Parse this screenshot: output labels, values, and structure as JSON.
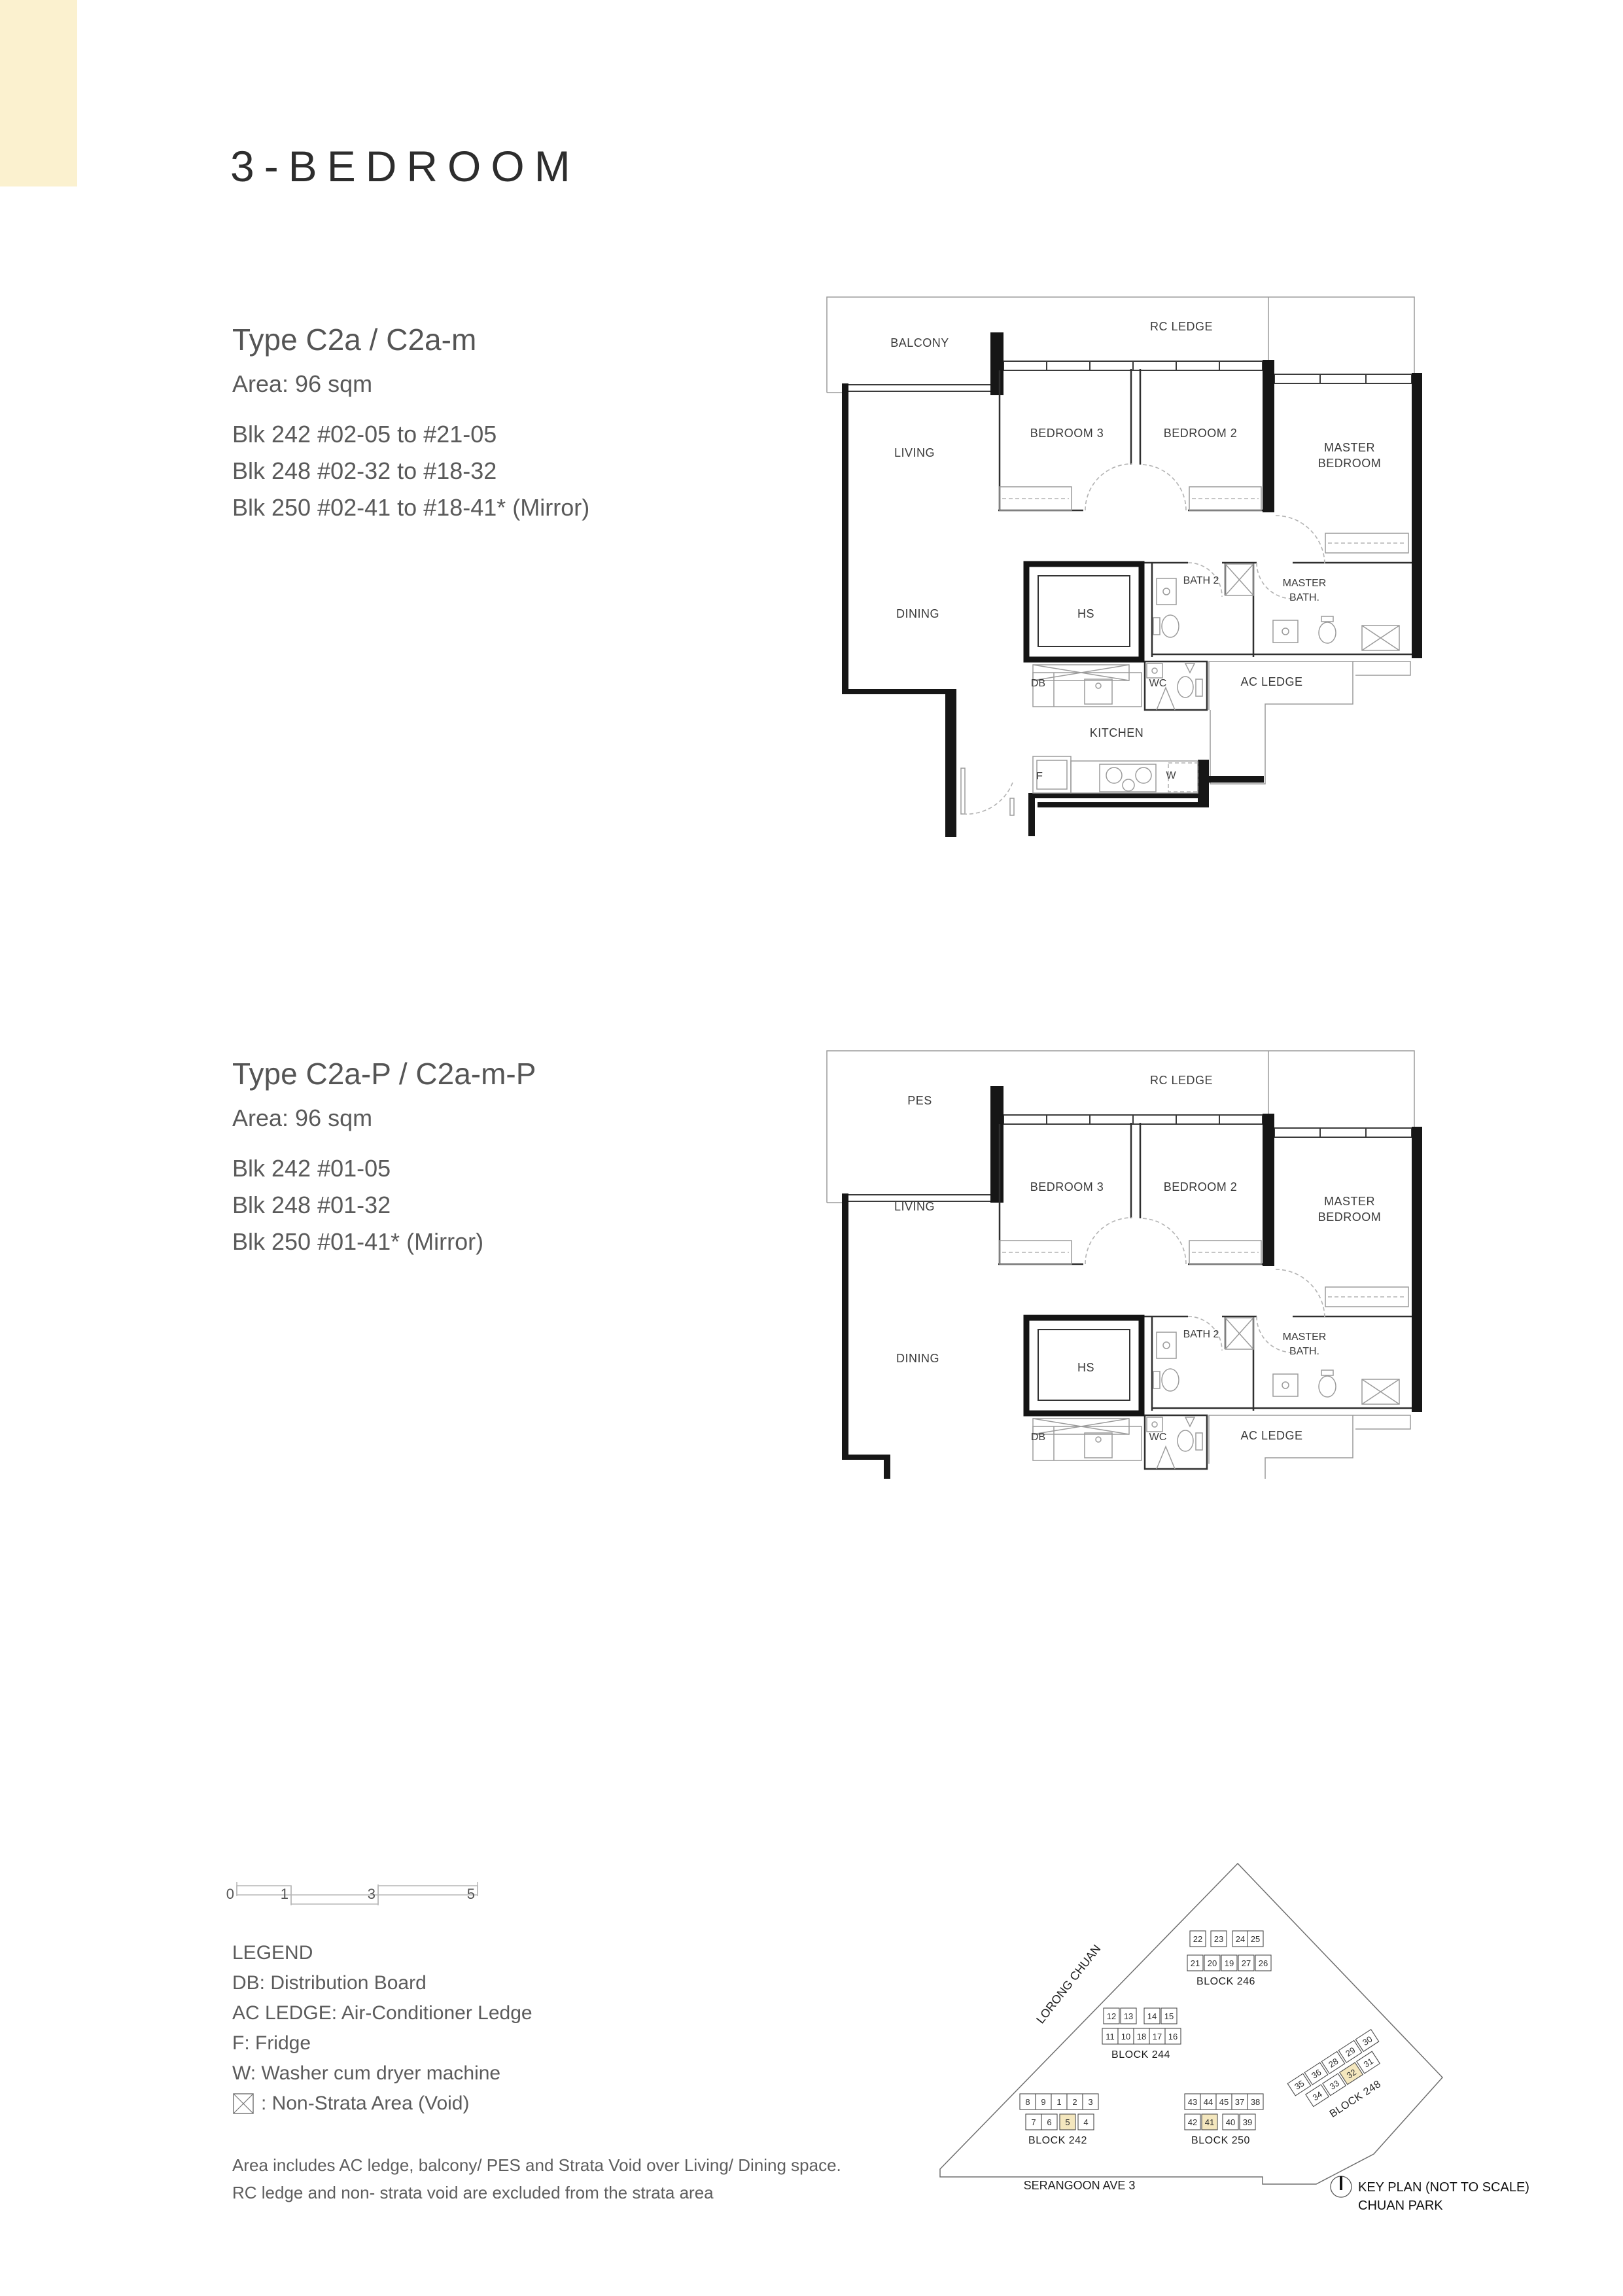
{
  "page": {
    "title": "3-BEDROOM",
    "accent_color": "#FBF1CF"
  },
  "type1": {
    "title": "Type C2a / C2a-m",
    "area": "Area: 96 sqm",
    "blocks": [
      "Blk 242  #02-05 to #21-05",
      "Blk 248  #02-32 to #18-32",
      "Blk 250  #02-41 to #18-41* (Mirror)"
    ]
  },
  "type2": {
    "title": "Type C2a-P / C2a-m-P",
    "area": "Area: 96 sqm",
    "blocks": [
      "Blk 242  #01-05",
      "Blk 248  #01-32",
      "Blk 250  #01-41* (Mirror)"
    ]
  },
  "plan1": {
    "labels": {
      "balcony": "BALCONY",
      "rc_ledge": "RC LEDGE",
      "bedroom3": "BEDROOM 3",
      "bedroom2": "BEDROOM 2",
      "master_bedroom_1": "MASTER",
      "master_bedroom_2": "BEDROOM",
      "living": "LIVING",
      "dining": "DINING",
      "hs": "HS",
      "bath2": "BATH 2",
      "master_bath_1": "MASTER",
      "master_bath_2": "BATH.",
      "db": "DB",
      "wc": "WC",
      "ac_ledge": "AC LEDGE",
      "kitchen": "KITCHEN",
      "f": "F",
      "w": "W"
    }
  },
  "plan2": {
    "labels": {
      "pes": "PES",
      "rc_ledge": "RC LEDGE",
      "bedroom3": "BEDROOM 3",
      "bedroom2": "BEDROOM 2",
      "master_bedroom_1": "MASTER",
      "master_bedroom_2": "BEDROOM",
      "living": "LIVING",
      "dining": "DINING",
      "hs": "HS",
      "bath2": "BATH 2",
      "master_bath_1": "MASTER",
      "master_bath_2": "BATH.",
      "db": "DB",
      "wc": "WC",
      "ac_ledge": "AC LEDGE"
    }
  },
  "scalebar": {
    "labels": [
      "0",
      "1",
      "3",
      "5"
    ]
  },
  "legend": {
    "title": "LEGEND",
    "items": [
      "DB: Distribution Board",
      "AC LEDGE: Air-Conditioner Ledge",
      "F: Fridge",
      "W: Washer cum dryer machine"
    ],
    "void_label": ": Non-Strata Area (Void)"
  },
  "note": {
    "line1": "Area includes AC ledge, balcony/ PES and Strata Void over Living/ Dining space.",
    "line2": "RC ledge and non- strata void are excluded from the strata area"
  },
  "keyplan": {
    "street1": "LORONG CHUAN",
    "street2": "SERANGOON AVE 3",
    "caption1": "KEY PLAN (NOT TO SCALE)",
    "caption2": "CHUAN PARK",
    "highlight_color": "#F4E7BE",
    "blocks": [
      {
        "name": "BLOCK 246",
        "rows": [
          [
            "22",
            "23",
            "24",
            "25"
          ],
          [
            "21",
            "20",
            "19",
            "27",
            "26"
          ]
        ]
      },
      {
        "name": "BLOCK 244",
        "rows": [
          [
            "12",
            "13",
            "14",
            "15"
          ],
          [
            "11",
            "10",
            "18",
            "17",
            "16"
          ]
        ]
      },
      {
        "name": "BLOCK 242",
        "rows": [
          [
            "8",
            "9",
            "1",
            "2",
            "3"
          ],
          [
            "7",
            "6",
            "5",
            "4"
          ]
        ],
        "highlight": "5"
      },
      {
        "name": "BLOCK 250",
        "rows": [
          [
            "43",
            "44",
            "45",
            "37",
            "38"
          ],
          [
            "42",
            "41",
            "40",
            "39"
          ]
        ],
        "highlight": "41"
      },
      {
        "name": "BLOCK 248",
        "rows": [
          [
            "35",
            "36",
            "28",
            "29",
            "30"
          ],
          [
            "34",
            "33",
            "32",
            "31"
          ]
        ],
        "highlight": "32"
      }
    ]
  }
}
